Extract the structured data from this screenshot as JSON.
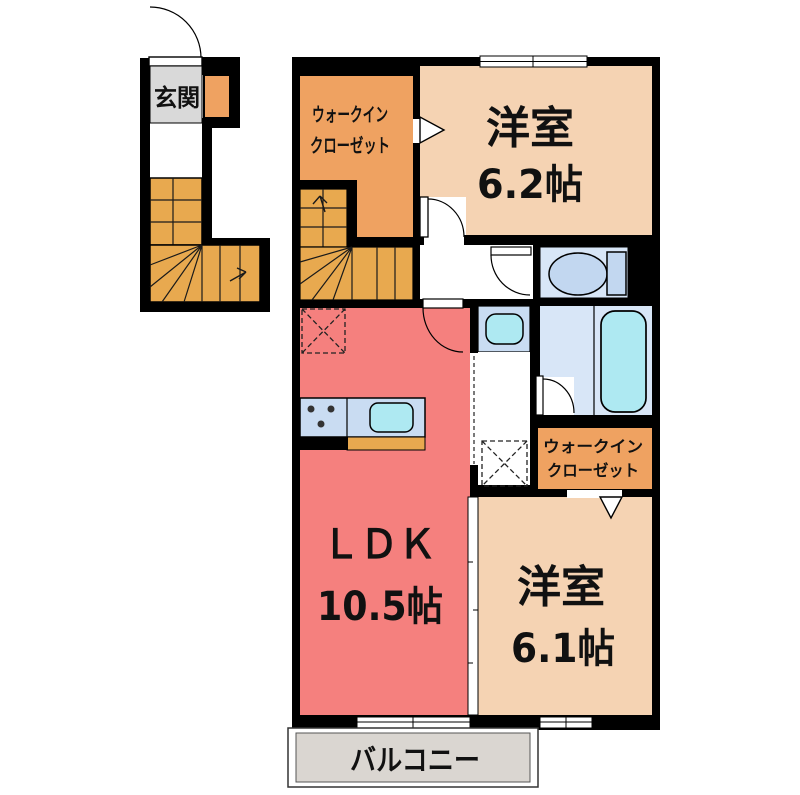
{
  "rooms": {
    "entrance": {
      "label": "玄関"
    },
    "walk_in_closet_1": {
      "line1": "ウォークイン",
      "line2": "クローゼット"
    },
    "western_room_62": {
      "name": "洋室",
      "size": "6.2帖"
    },
    "ldk": {
      "name": "ＬＤＫ",
      "size": "10.5帖"
    },
    "walk_in_closet_2": {
      "line1": "ウォークイン",
      "line2": "クローゼット"
    },
    "western_room_61": {
      "name": "洋室",
      "size": "6.1帖"
    },
    "balcony": {
      "label": "バルコニー"
    }
  },
  "colors": {
    "wall": "#000000",
    "room_peach": "#F5D3B3",
    "ldk_red": "#F5807E",
    "closet_orange": "#EFA261",
    "stairs_orange": "#E8A94F",
    "water_blue": "#D8E6F7",
    "unit_blue": "#C9DCF2",
    "fixture_blue": "#C2D7F0",
    "sink_cyan": "#AEE9F2",
    "entrance_gray": "#D9D9D9",
    "balcony_gray": "#DAD6D1"
  }
}
